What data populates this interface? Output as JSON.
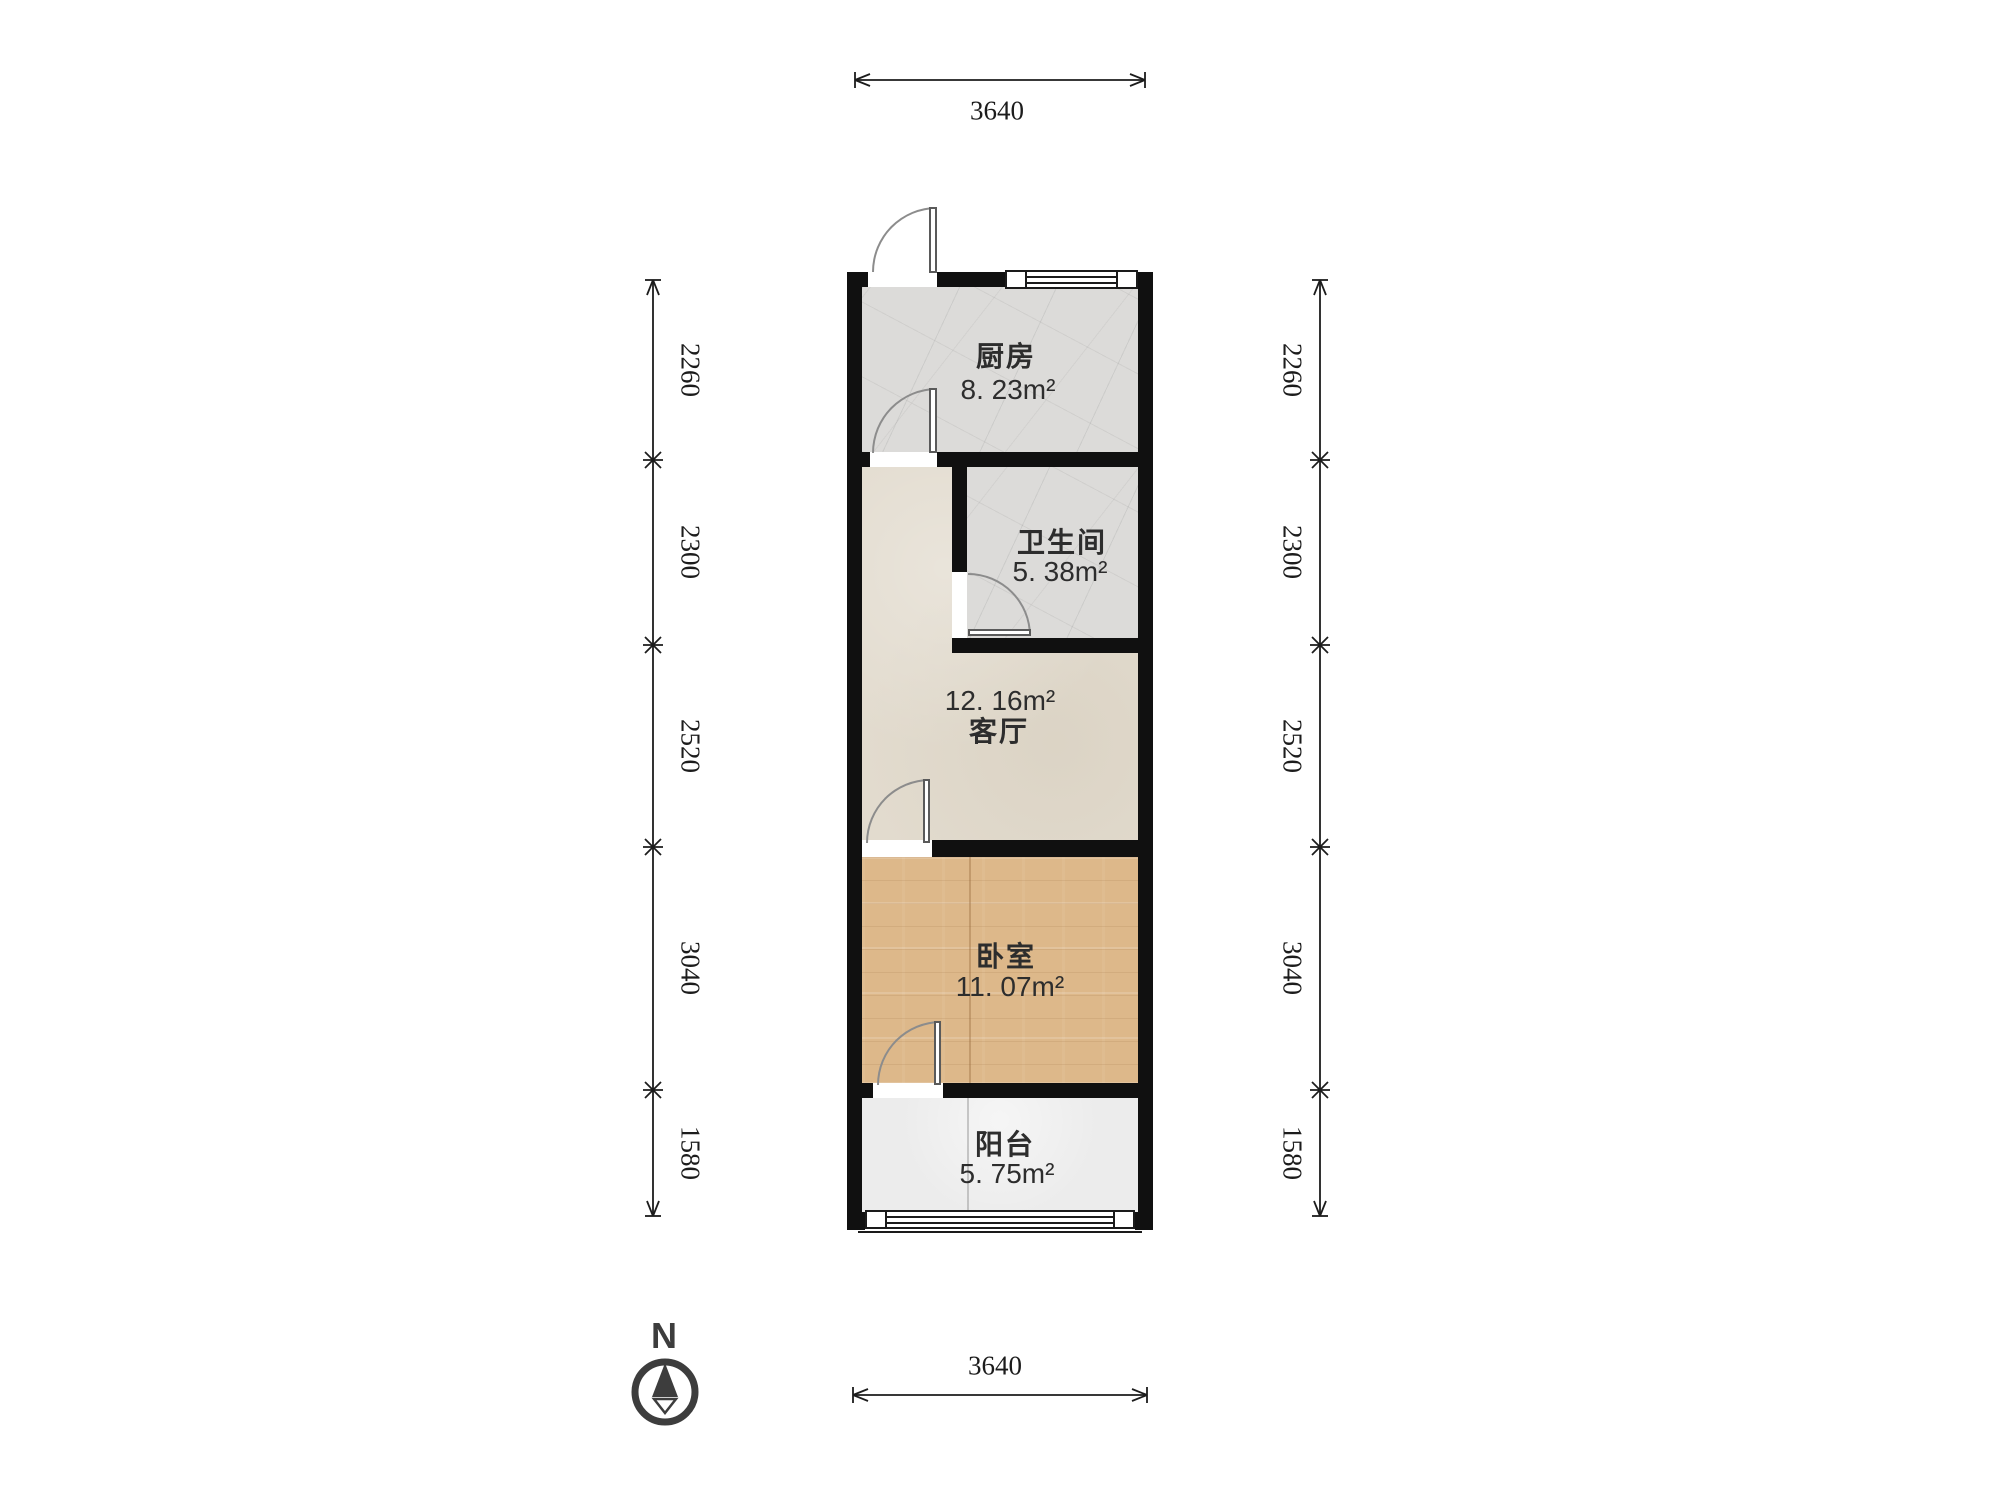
{
  "plan_title": "一室一厅户型图",
  "compass": {
    "label": "N"
  },
  "dimensions": {
    "unit": "mm",
    "top": "3640",
    "bottom": "3640",
    "left": [
      "2260",
      "2300",
      "2520",
      "3040",
      "1580"
    ],
    "right": [
      "2260",
      "2300",
      "2520",
      "3040",
      "1580"
    ]
  },
  "rooms": {
    "kitchen": {
      "name": "厨房",
      "area": "8. 23m²"
    },
    "bathroom": {
      "name": "卫生间",
      "area": "5. 38m²"
    },
    "living": {
      "name": "客厅",
      "area": "12. 16m²"
    },
    "bedroom": {
      "name": "卧室",
      "area": "11. 07m²"
    },
    "balcony": {
      "name": "阳台",
      "area": "5. 75m²"
    }
  },
  "colors": {
    "wall": "#101010",
    "tile_floor": "#dcdbd9",
    "living_floor": "#e2dbce",
    "wood_floor": "#ddb88a",
    "balcony_floor": "#ececec",
    "dimension_text": "#1c1c1c",
    "compass": "#3d3d3d",
    "background": "#ffffff"
  }
}
